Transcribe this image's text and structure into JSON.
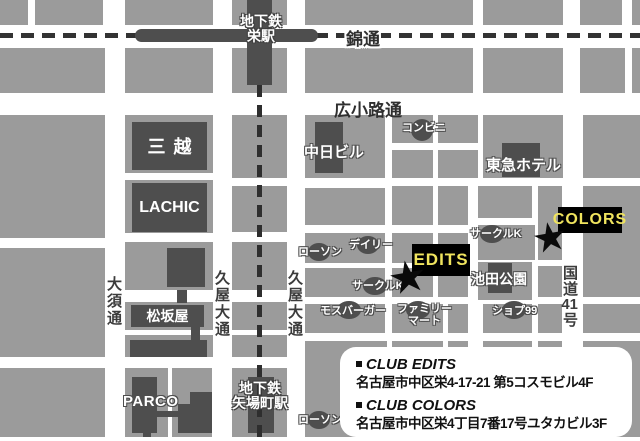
{
  "stations": {
    "sakae": {
      "line1": "地下鉄",
      "line2": "栄駅"
    },
    "yabacho": {
      "line1": "地下鉄",
      "line2": "矢場町駅"
    }
  },
  "streets": {
    "nishiki": "錦通",
    "hirokoji": "広小路通",
    "osu": "大須通",
    "hisaya_west": "久屋大通",
    "hisaya_east": "久屋大通",
    "route41_part1": "国道",
    "route41_part2": "41",
    "route41_part3": "号"
  },
  "landmarks": {
    "mitsukoshi": "三越",
    "lachic": "LACHIC",
    "chunichi_bldg": "中日ビル",
    "tokyu_hotel": "東急ホテル",
    "matsuzakaya": "松坂屋",
    "parco": "PARCO",
    "ikeda_park": "池田公園"
  },
  "pois": {
    "conbini": "コンビニ",
    "lawson_mid": "ローソン",
    "daily": "デイリー",
    "circlek_north": "サークルK",
    "circlek_west": "サークルK",
    "mos_burger": "モスバーガー",
    "familymart_line1": "ファミリー",
    "familymart_line2": "マート",
    "shop99": "ショプ99",
    "lawson_south": "ローソン"
  },
  "venues": {
    "edits_label": "EDITS",
    "colors_label": "COLORS",
    "marker": "★"
  },
  "info_box": {
    "clubs": [
      {
        "name": "CLUB EDITS",
        "address": "名古屋市中区栄4-17-21 第5コスモビル4F"
      },
      {
        "name": "CLUB COLORS",
        "address": "名古屋市中区栄4丁目7番17号ユタカビル3F"
      }
    ]
  },
  "colors": {
    "block_gray": "#9b9b9b",
    "building_dark": "#4e4e4e",
    "line_dark": "#333333",
    "venue_bg": "#000000",
    "venue_text_yellow": "#f0e45e"
  }
}
